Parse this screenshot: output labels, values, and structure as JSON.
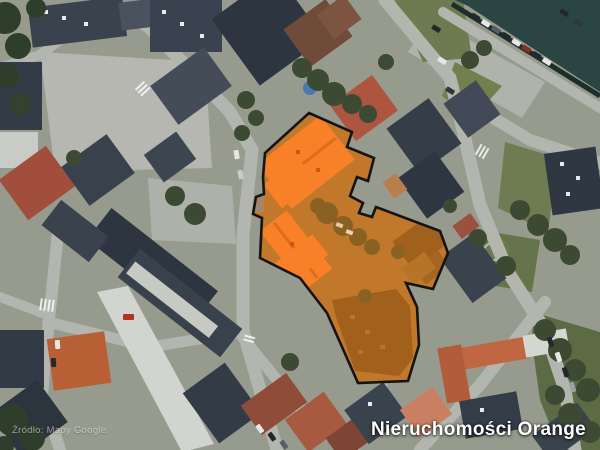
{
  "map": {
    "type": "satellite",
    "attribution": "Źródło: Mapy Google",
    "brand": "Nieruchomości Orange",
    "colors": {
      "highlight_outline": "#141414",
      "highlight_tint": "#f57c20",
      "highlight_roof_bright": "#f8822b",
      "highlight_roof_dark": "#8a5a1d",
      "highlight_courtyard": "#b2782e",
      "river": "#2b4543",
      "street": "#b3b6ae"
    },
    "highlight": {
      "boundary_points": "309,113 352,132 347,147 374,158 368,181 357,177 350,196 363,203 359,213 372,217 376,207 440,231 448,253 433,289 406,283 417,307 419,345 408,381 358,383 327,313 300,278 260,258 262,218 253,214 256,197 264,194 263,177 265,153"
    }
  }
}
